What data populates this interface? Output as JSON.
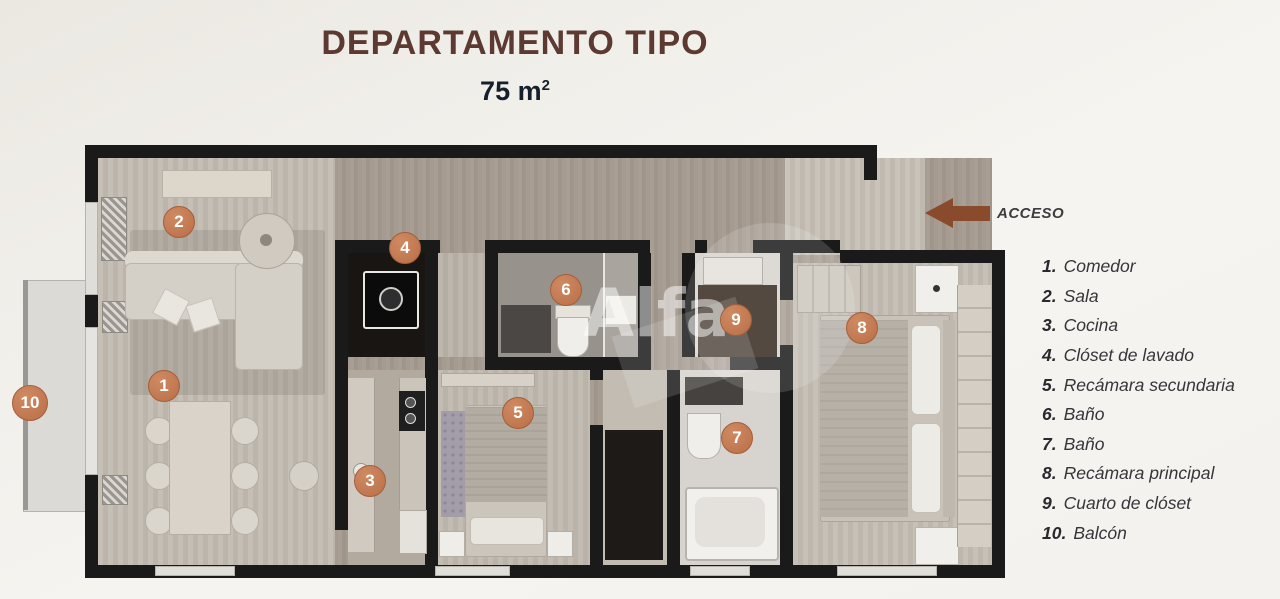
{
  "header": {
    "title": "DEPARTAMENTO TIPO",
    "area": "75 m",
    "area_exponent": "2"
  },
  "access": {
    "label": "ACCESO"
  },
  "watermark": {
    "text": "Alfa"
  },
  "colors": {
    "badge": "#c0795a",
    "arrow": "#8a4a2c",
    "title": "#5d3a31",
    "area_text": "#16202c",
    "wall": "#1a1a1a"
  },
  "plan": {
    "badges": [
      "1",
      "2",
      "3",
      "4",
      "5",
      "6",
      "7",
      "8",
      "9",
      "10"
    ]
  },
  "legend": {
    "items": [
      {
        "num": "1.",
        "label": "Comedor"
      },
      {
        "num": "2.",
        "label": "Sala"
      },
      {
        "num": "3.",
        "label": "Cocina"
      },
      {
        "num": "4.",
        "label": "Clóset de lavado"
      },
      {
        "num": "5.",
        "label": "Recámara secundaria"
      },
      {
        "num": "6.",
        "label": "Baño"
      },
      {
        "num": "7.",
        "label": "Baño"
      },
      {
        "num": "8.",
        "label": "Recámara principal"
      },
      {
        "num": "9.",
        "label": "Cuarto de clóset"
      },
      {
        "num": "10.",
        "label": "Balcón"
      }
    ]
  }
}
